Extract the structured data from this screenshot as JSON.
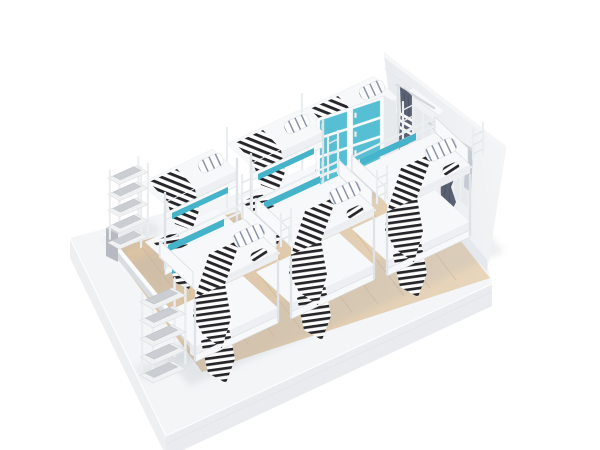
{
  "meta": {
    "title": "Dormitory room isometric 3D render",
    "render_style": "studio product render on white background"
  },
  "scene": {
    "room": {
      "floor": "light wood planks",
      "left_wall": "low cutaway white wall",
      "right_wall": "tall white wall with two curtained windows",
      "base": "white display plinth"
    },
    "furniture": {
      "bunk_beds_back_row": 3,
      "bunk_beds_front_row": 3,
      "locker_cabinet": {
        "columns": 2,
        "rows": 4,
        "doors": 8,
        "door_color_name": "teal"
      },
      "storage_racks": 2,
      "windows": 2,
      "curtains": 2,
      "air_conditioner": 1
    },
    "bedding": {
      "blanket": "black and white striped",
      "pillow": "white with navy stripes",
      "accent_rail": "teal"
    }
  },
  "colors": {
    "background": "#ffffff",
    "teal": "#57bfd3",
    "tealRail": "#45b4ca",
    "wood": "#d9c1a2",
    "woodLight": "#e8d6bc",
    "woodLine": "#c8ab89",
    "wallShade": "#e7eaee",
    "wallLight": "#f4f6f7",
    "plinthTop": "#f3f5f7",
    "plinthFace": "#e9ebee",
    "plinthSide": "#edeff1",
    "curtain": "#5a6173",
    "curtainFold": "#494f60",
    "curtainSheer": "#aab1bd",
    "blanketStripe": "#26262a",
    "pillowStripe": "#3d4e6e",
    "frame": "#f6f8f9",
    "frameEdge": "#d9dde1",
    "mattress": "#f7f8fa",
    "capGray": "#b7bbc1"
  }
}
